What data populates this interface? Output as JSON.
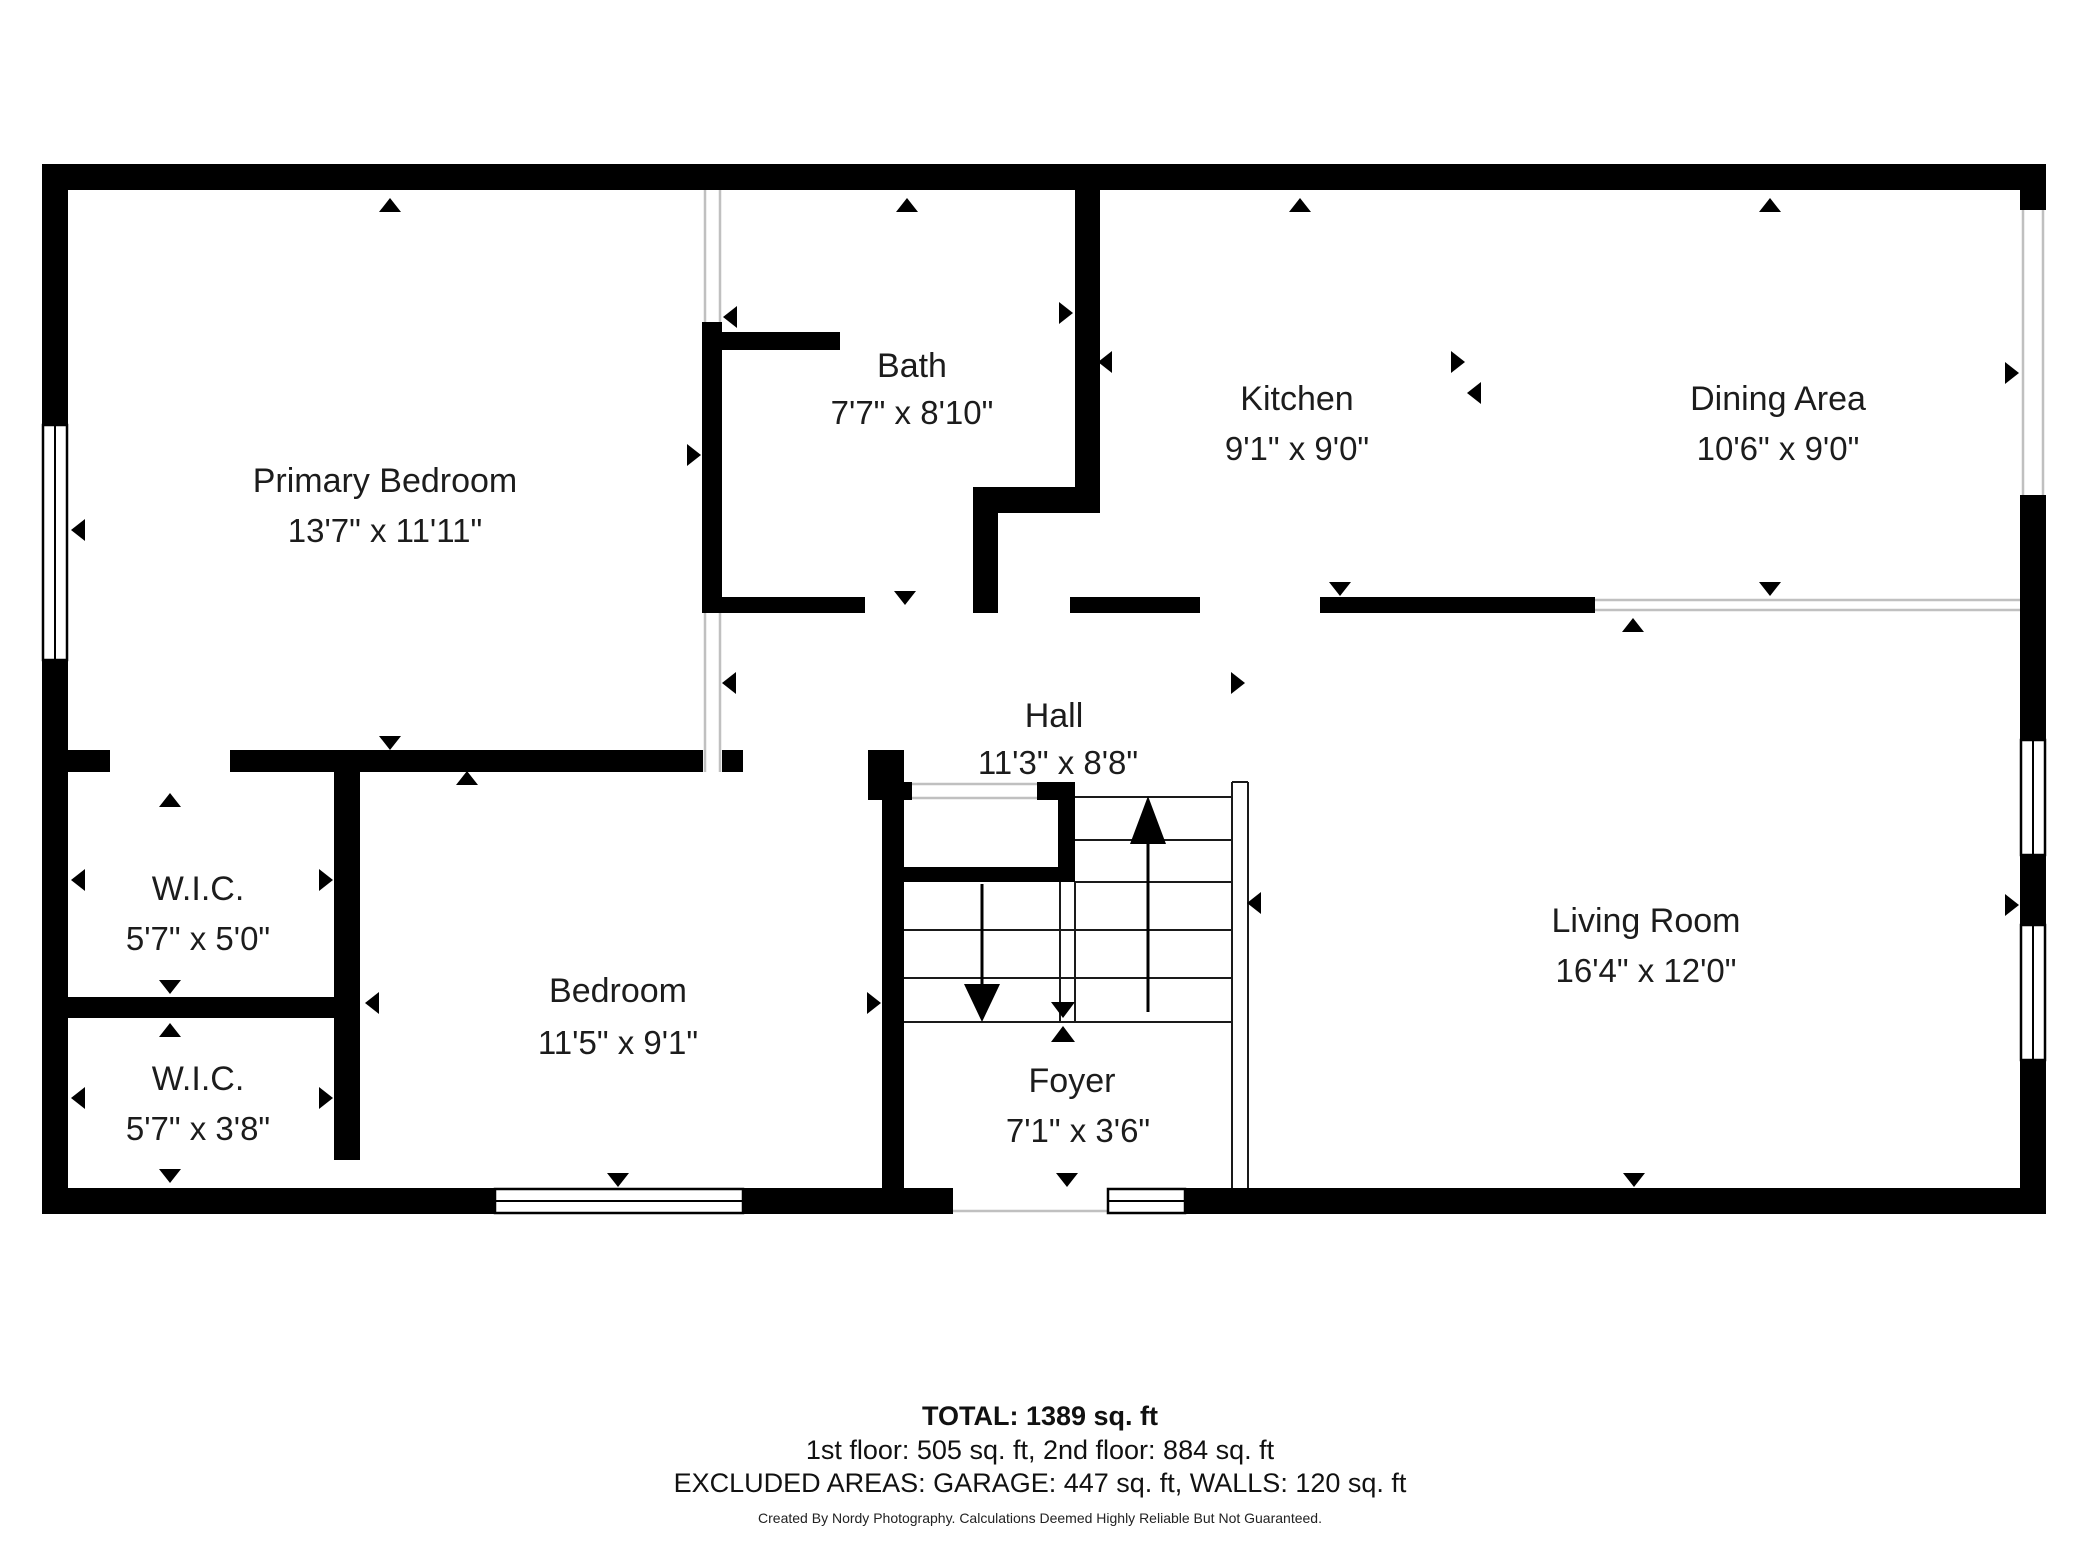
{
  "plan": {
    "type": "floor-plan",
    "colors": {
      "wall": "#000000",
      "background": "#ffffff",
      "open_boundary": "#c0c0c0",
      "text": "#1c1c1c"
    },
    "rooms": [
      {
        "name": "Primary Bedroom",
        "dims": "13'7\" x 11'11\""
      },
      {
        "name": "Bath",
        "dims": "7'7\" x 8'10\""
      },
      {
        "name": "Kitchen",
        "dims": "9'1\" x 9'0\""
      },
      {
        "name": "Dining Area",
        "dims": "10'6\" x 9'0\""
      },
      {
        "name": "Hall",
        "dims": "11'3\" x 8'8\""
      },
      {
        "name": "W.I.C.",
        "dims": "5'7\" x 5'0\""
      },
      {
        "name": "W.I.C.",
        "dims": "5'7\" x 3'8\""
      },
      {
        "name": "Bedroom",
        "dims": "11'5\" x 9'1\""
      },
      {
        "name": "Foyer",
        "dims": "7'1\" x 3'6\""
      },
      {
        "name": "Living Room",
        "dims": "16'4\" x 12'0\""
      }
    ],
    "features": [
      "staircase-up-arrow",
      "staircase-down-arrow",
      "windows",
      "door-openings",
      "dimension-arrows"
    ]
  },
  "summary": {
    "total": "TOTAL: 1389 sq. ft",
    "floors": "1st floor: 505 sq. ft, 2nd floor: 884 sq. ft",
    "excluded": "EXCLUDED AREAS: GARAGE: 447 sq. ft, WALLS: 120 sq. ft",
    "credit": "Created By Nordy Photography. Calculations Deemed Highly Reliable But Not Guaranteed."
  }
}
